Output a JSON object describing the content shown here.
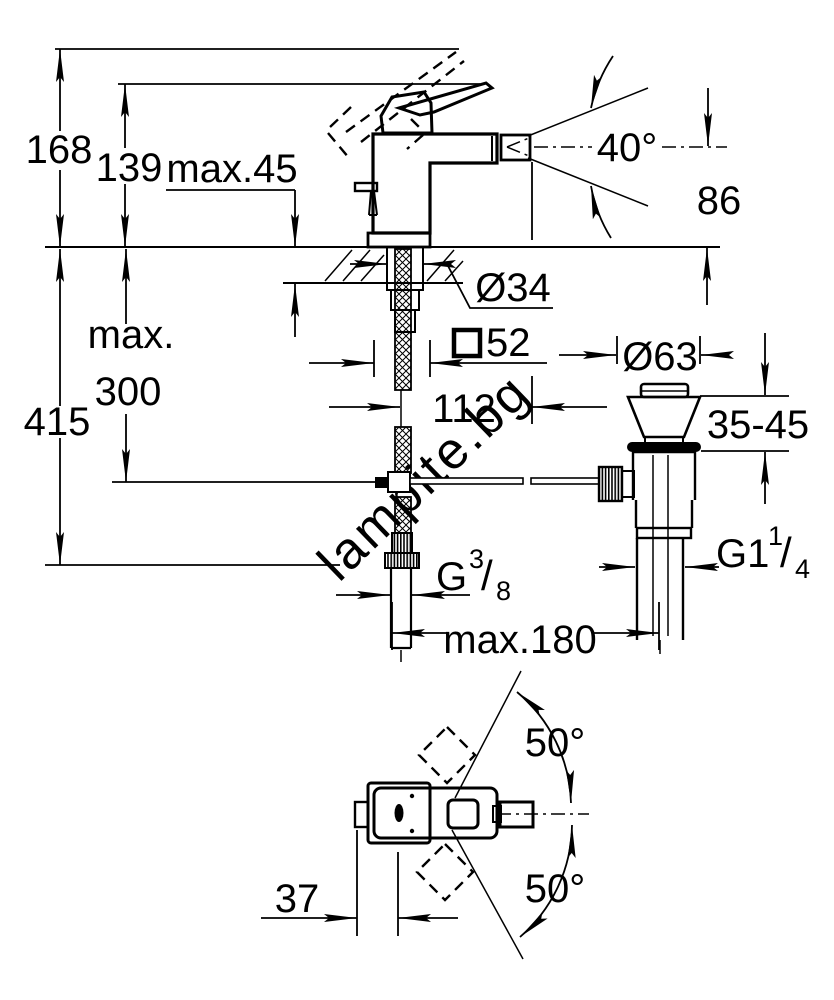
{
  "watermark": "lampite.bg",
  "labels": {
    "height_total": "168",
    "height_spout": "139",
    "deck_thickness": "max.45",
    "spray_angle": "40°",
    "spout_to_deck": "86",
    "hole_diameter": "Ø34",
    "body_square": "52",
    "depth_line1": "max.",
    "depth_line2": "300",
    "height_below": "415",
    "spout_reach": "112",
    "waste_flange_diameter": "Ø63",
    "basin_thickness": "35-45",
    "supply_thread_g": "G",
    "supply_thread_num": "3",
    "supply_thread_slash": "/",
    "supply_thread_den": "8",
    "waste_thread_g": "G1",
    "waste_thread_num": "1",
    "waste_thread_slash": "/",
    "waste_thread_den": "4",
    "center_distance": "max.180",
    "swivel_up": "50°",
    "swivel_down": "50°",
    "rod_offset": "37"
  }
}
